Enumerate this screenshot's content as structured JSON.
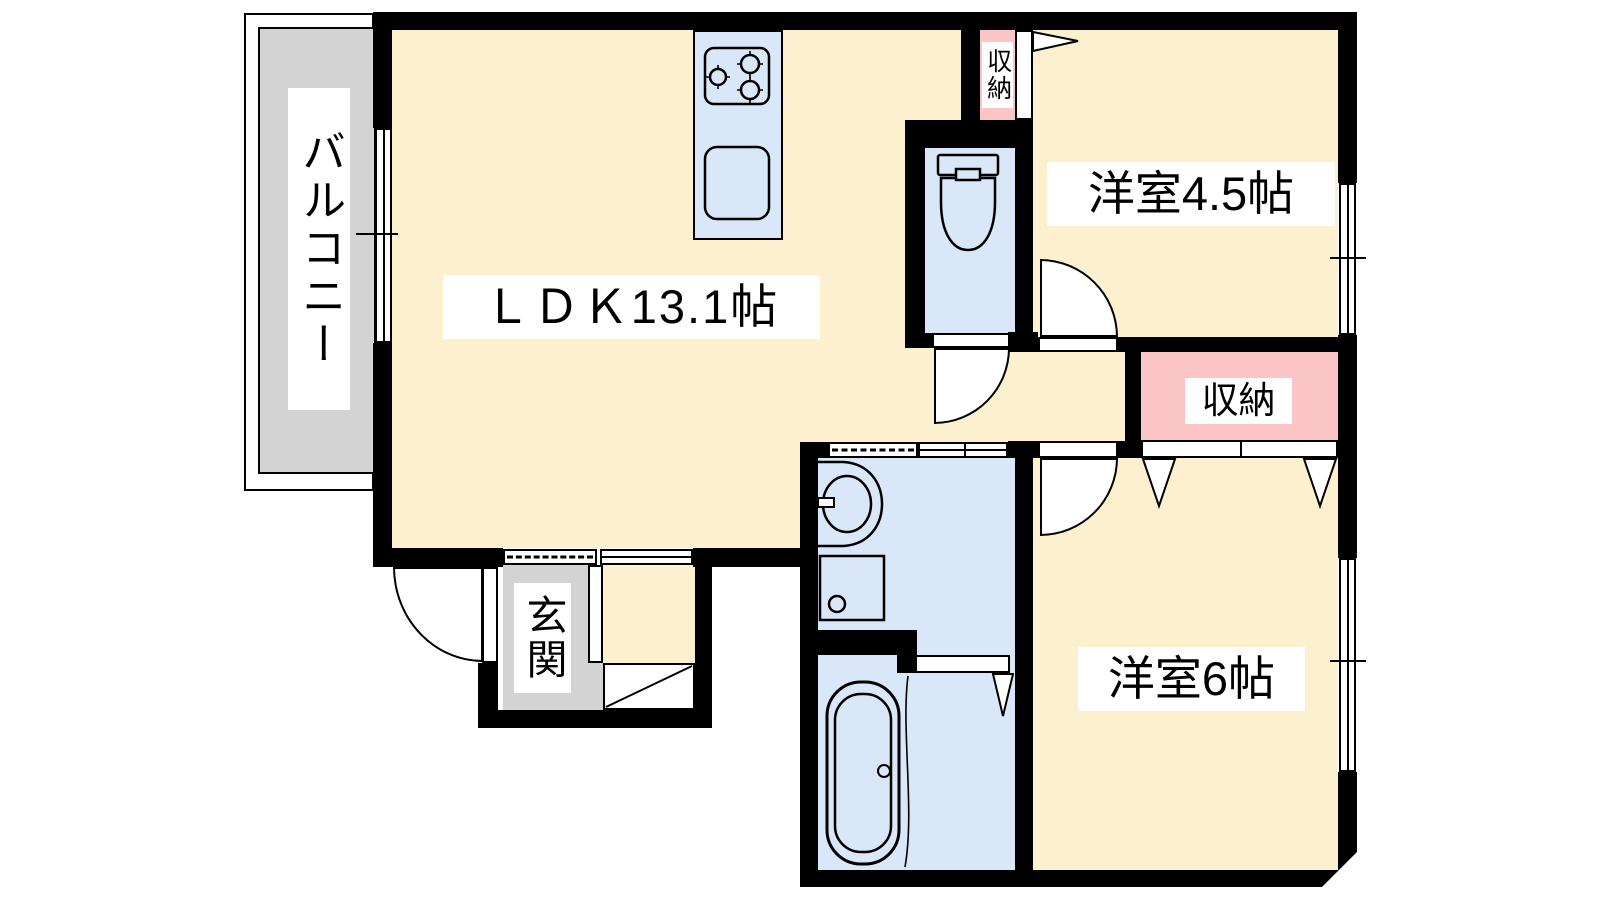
{
  "title": "apartment-floor-plan",
  "colors": {
    "floor-cream": "#FCF0CF",
    "wet-blue": "#D9E7F8",
    "storage-pink": "#FBC5C6",
    "balcony-gray": "#D3D3D3",
    "wall-black": "#000000",
    "label-bg": "#FFFFFF",
    "text": "#000000"
  },
  "rooms": {
    "balcony": {
      "label": "バルコニー"
    },
    "ldk": {
      "label": "ＬＤＫ13.1帖",
      "size_jo": 13.1
    },
    "western_room_45": {
      "label": "洋室4.5帖",
      "size_jo": 4.5
    },
    "western_room_6": {
      "label": "洋室6帖",
      "size_jo": 6
    },
    "storage_top": {
      "label": "収納"
    },
    "storage_mid": {
      "label": "収納"
    },
    "entrance": {
      "label": "玄関"
    }
  },
  "fixtures": [
    {
      "name": "stove-icon"
    },
    {
      "name": "kitchen-sink-icon"
    },
    {
      "name": "toilet-icon"
    },
    {
      "name": "washbasin-icon"
    },
    {
      "name": "washing-machine-pan-icon"
    },
    {
      "name": "bathtub-icon"
    },
    {
      "name": "window-icon"
    },
    {
      "name": "door-swing-icon"
    },
    {
      "name": "folding-door-icon"
    },
    {
      "name": "shoe-cabinet-icon"
    }
  ]
}
